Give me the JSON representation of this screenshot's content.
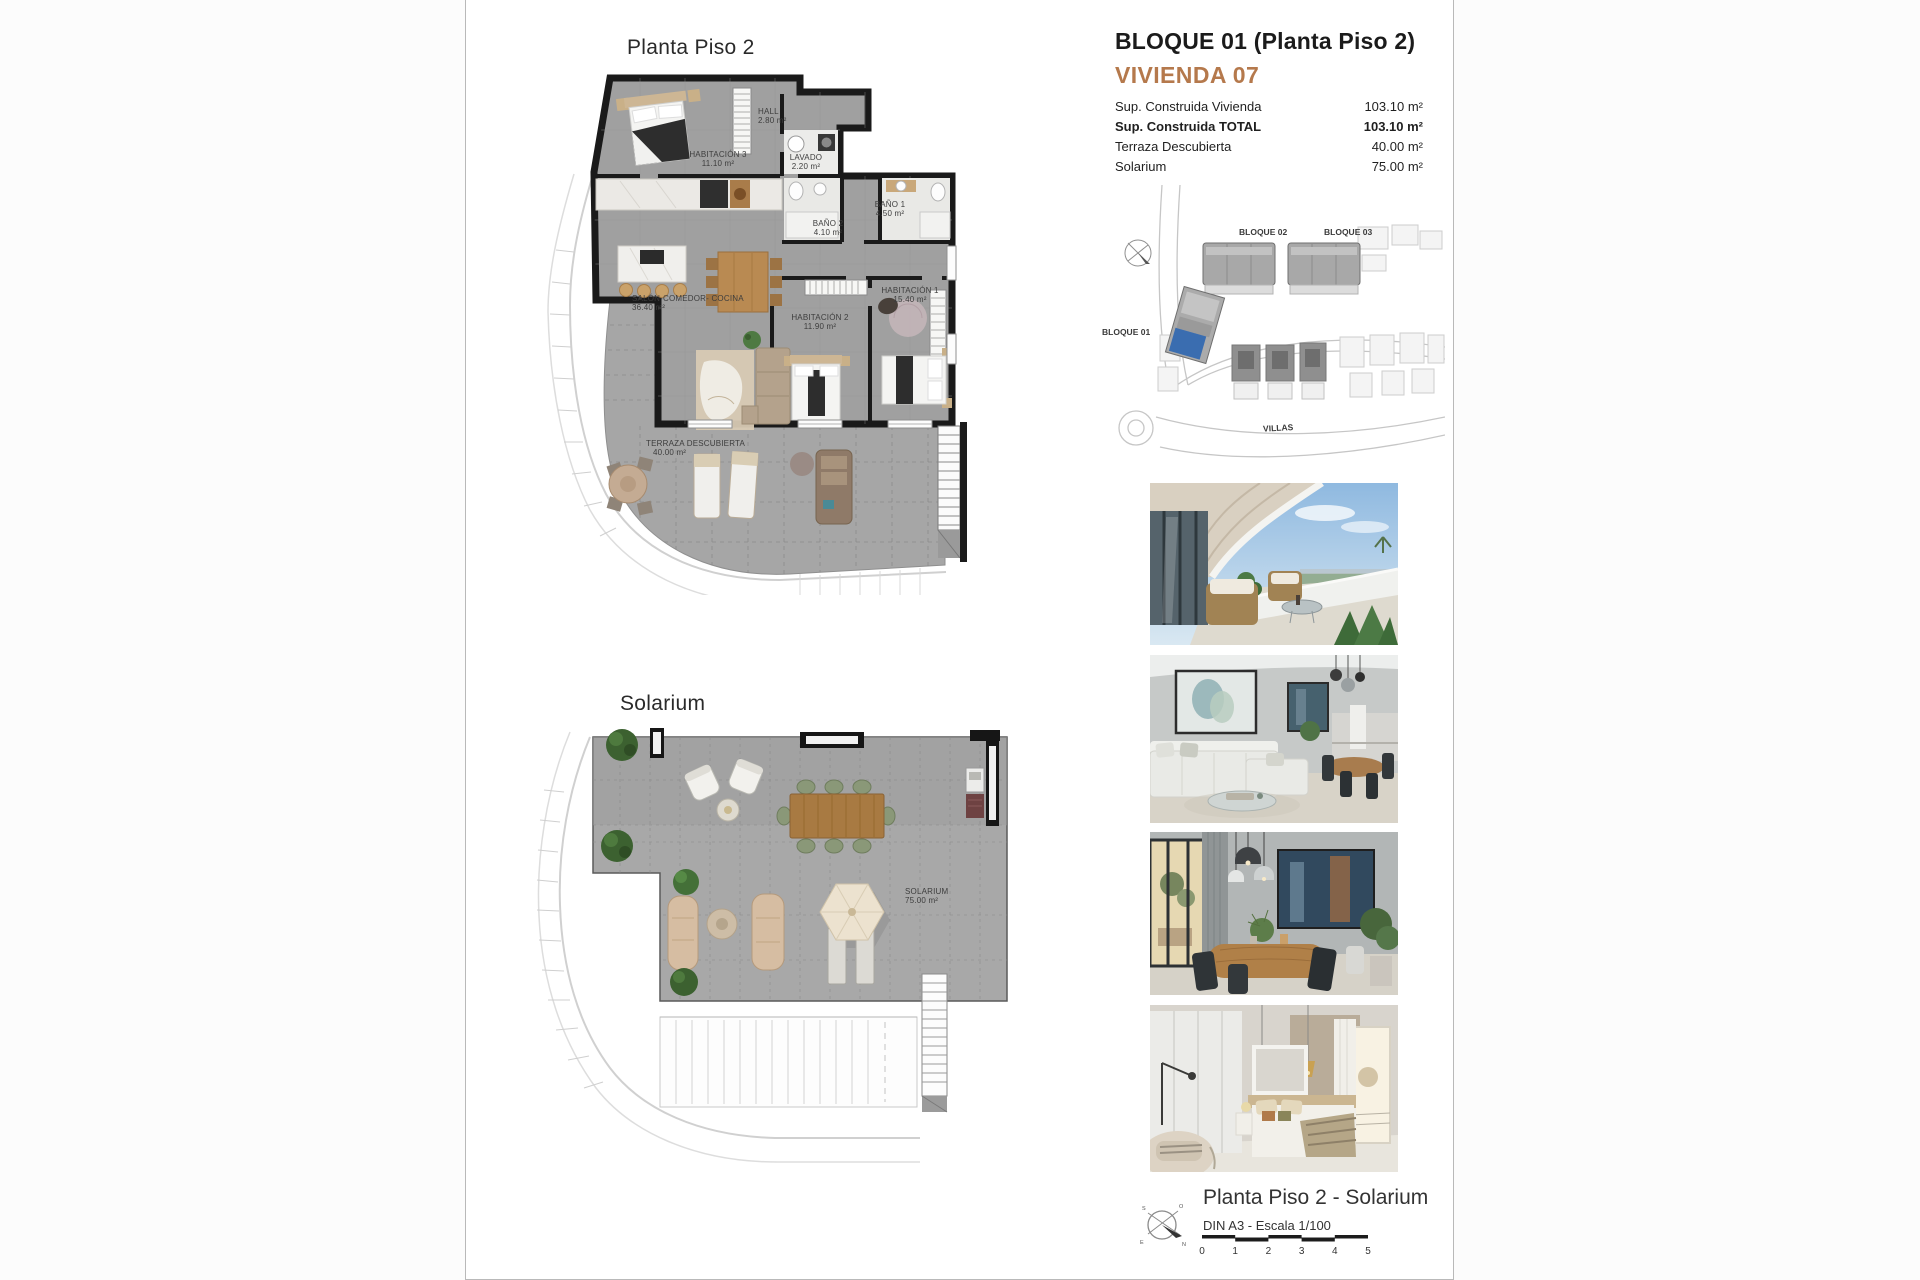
{
  "page": {
    "plan1_title": "Planta Piso 2",
    "plan2_title": "Solarium"
  },
  "header": {
    "block_title": "BLOQUE 01  (Planta Piso 2)",
    "unit_title": "VIVIENDA 07",
    "accent_color": "#b5794c",
    "areas": [
      {
        "label": "Sup. Construida Vivienda",
        "value": "103.10 m²"
      },
      {
        "label": "Sup. Construida TOTAL",
        "value": "103.10 m²"
      },
      {
        "label": "Terraza Descubierta",
        "value": "40.00 m²"
      },
      {
        "label": "Solarium",
        "value": "75.00 m²"
      }
    ]
  },
  "site_plan": {
    "bloque01": "BLOQUE 01",
    "bloque02": "BLOQUE 02",
    "bloque03": "BLOQUE 03",
    "villas": "VILLAS",
    "highlight_color": "#3a6db0"
  },
  "floor_plan": {
    "rooms": [
      {
        "name": "HALL",
        "area": "2.80 m²"
      },
      {
        "name": "HABITACIÓN 3",
        "area": "11.10 m²"
      },
      {
        "name": "LAVADO",
        "area": "2.20 m²"
      },
      {
        "name": "BAÑO 2",
        "area": "4.10 m²"
      },
      {
        "name": "BAÑO 1",
        "area": "4.50 m²"
      },
      {
        "name": "HABITACIÓN 1",
        "area": "15.40 m²"
      },
      {
        "name": "HABITACIÓN 2",
        "area": "11.90 m²"
      },
      {
        "name": "SALÓN-COMEDOR- COCINA",
        "area": "36.40 m²"
      },
      {
        "name": "TERRAZA DESCUBIERTA",
        "area": "40.00 m²"
      }
    ]
  },
  "solarium_plan": {
    "name": "SOLARIUM",
    "area": "75.00 m²"
  },
  "footer": {
    "title": "Planta Piso 2 - Solarium",
    "subtitle": "DIN A3 - Escala 1/100",
    "ticks": [
      "0",
      "1",
      "2",
      "3",
      "4",
      "5"
    ]
  },
  "compass": {
    "n": "N",
    "s": "S",
    "e": "E",
    "o": "O"
  },
  "photos": [
    {
      "name": "terrace-render"
    },
    {
      "name": "living-room-render"
    },
    {
      "name": "dining-room-render"
    },
    {
      "name": "bedroom-render"
    }
  ]
}
